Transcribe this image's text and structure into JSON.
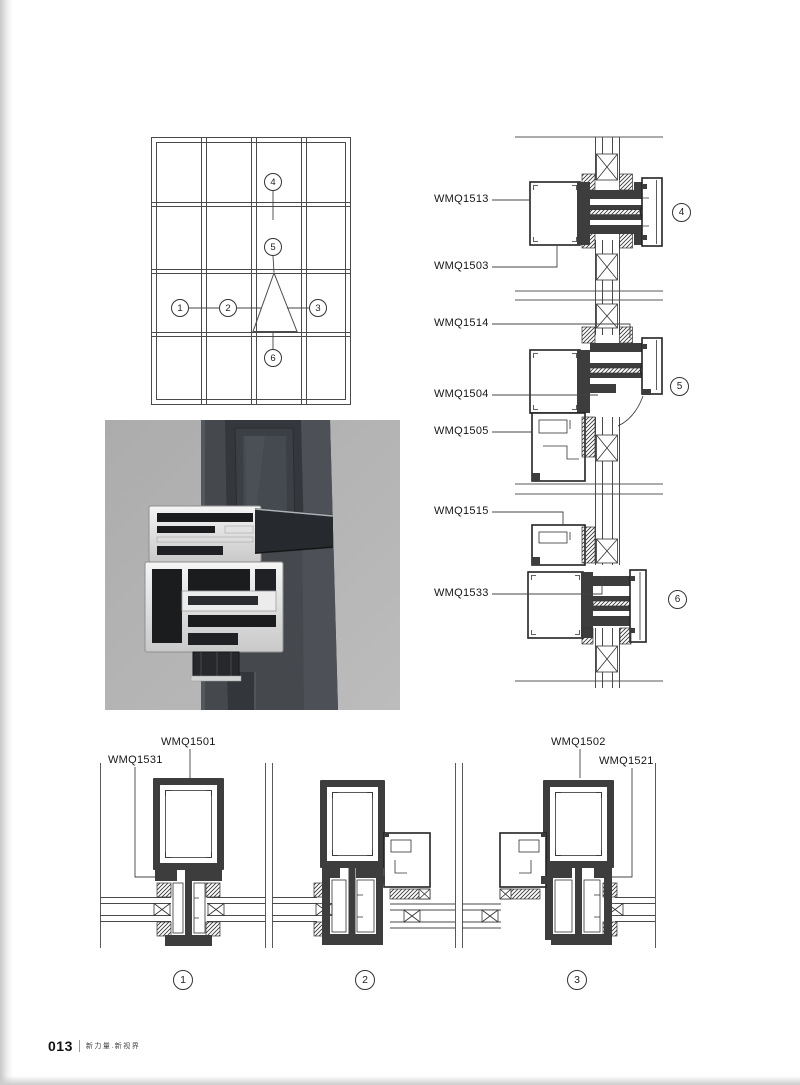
{
  "footer": {
    "page_number": "013",
    "slogan": "新力量.新视界"
  },
  "elevation": {
    "callouts": [
      "1",
      "2",
      "3",
      "4",
      "5",
      "6"
    ]
  },
  "vsec": {
    "labels": [
      "WMQ1513",
      "WMQ1503",
      "WMQ1514",
      "WMQ1504",
      "WMQ1505",
      "WMQ1515",
      "WMQ1533"
    ],
    "callouts": [
      "4",
      "5",
      "6"
    ]
  },
  "hsec": {
    "labels": [
      "WMQ1501",
      "WMQ1531",
      "WMQ1502",
      "WMQ1521"
    ],
    "callouts": [
      "1",
      "2",
      "3"
    ]
  }
}
